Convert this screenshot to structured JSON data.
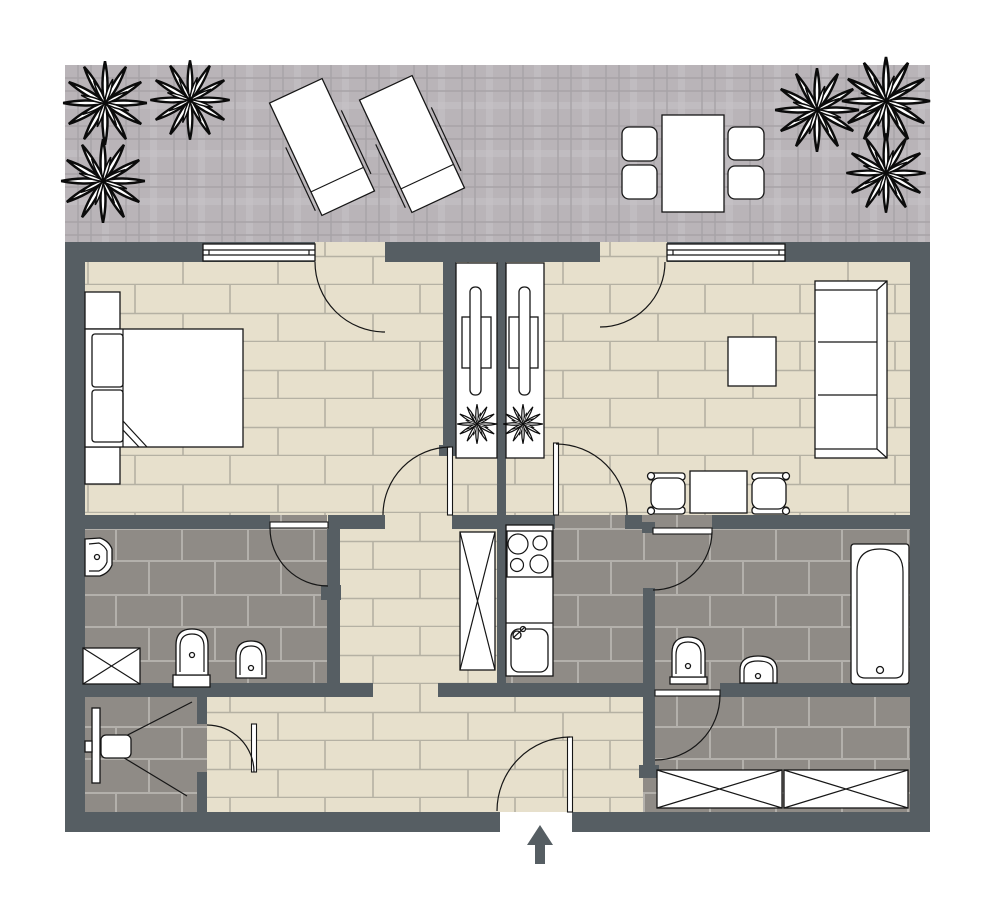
{
  "colors": {
    "wall": "#565e63",
    "wood": "#e7e0cc",
    "wood_line": "#b5b1a3",
    "tile": "#8f8b86",
    "tile_line": "#b3b0ab",
    "terrace": "#b9b4b8",
    "terrace_band": "#c6c2c6",
    "terrace_line": "#a7a3a7",
    "outline": "#161616"
  },
  "plan": {
    "type": "apartment-floor-plan",
    "text_labels": [],
    "window_count": 2,
    "door_arc_count": 9,
    "entrance": {
      "symbol": "entry-arrow-up",
      "position": "bottom-center"
    }
  },
  "terrace": {
    "floor": "plaid-stone",
    "items": [
      "plant-icon",
      "plant-icon",
      "plant-icon",
      "plant-icon",
      "plant-icon",
      "plant-icon",
      "sun-lounger-icon",
      "sun-lounger-icon",
      "dining-table-icon",
      "chair-icon",
      "chair-icon",
      "chair-icon",
      "chair-icon"
    ]
  },
  "rooms": [
    {
      "name": "bedroom",
      "floor": "wood-plank",
      "items": [
        "double-bed-icon",
        "pillow-icon",
        "pillow-icon",
        "nightstand-icon",
        "nightstand-icon",
        "window-icon",
        "terrace-door-arc",
        "room-door-arc"
      ]
    },
    {
      "name": "living-room",
      "floor": "wood-plank",
      "items": [
        "sofa-3-seat-icon",
        "coffee-table-icon",
        "desk-table-icon",
        "armchair-icon",
        "armchair-icon",
        "window-icon",
        "terrace-door-arc"
      ]
    },
    {
      "name": "tv-niche-left",
      "floor": "white-panel",
      "items": [
        "tv-panel-icon",
        "plant-icon"
      ]
    },
    {
      "name": "tv-niche-right",
      "floor": "white-panel",
      "items": [
        "tv-panel-icon",
        "plant-icon"
      ]
    },
    {
      "name": "ensuite-bathroom",
      "floor": "gray-tile",
      "items": [
        "washbasin-icon",
        "washing-machine-icon",
        "toilet-icon",
        "bidet-icon",
        "door-arc"
      ]
    },
    {
      "name": "shower-room",
      "floor": "gray-tile",
      "items": [
        "shower-icon",
        "door-arc"
      ]
    },
    {
      "name": "kitchen",
      "floor": "gray-tile",
      "items": [
        "tall-cabinet-icon",
        "stove-4-burner-icon",
        "counter-icon",
        "sink-icon",
        "door-arc"
      ]
    },
    {
      "name": "bathroom",
      "floor": "gray-tile",
      "items": [
        "toilet-icon",
        "washbasin-icon",
        "bathtub-icon",
        "door-arc"
      ]
    },
    {
      "name": "hallway",
      "floor": "wood-plank",
      "items": [
        "entrance-door-arc"
      ]
    },
    {
      "name": "storage-room",
      "floor": "gray-tile",
      "items": [
        "wardrobe-box-icon",
        "wardrobe-box-icon",
        "door-arc"
      ]
    }
  ]
}
